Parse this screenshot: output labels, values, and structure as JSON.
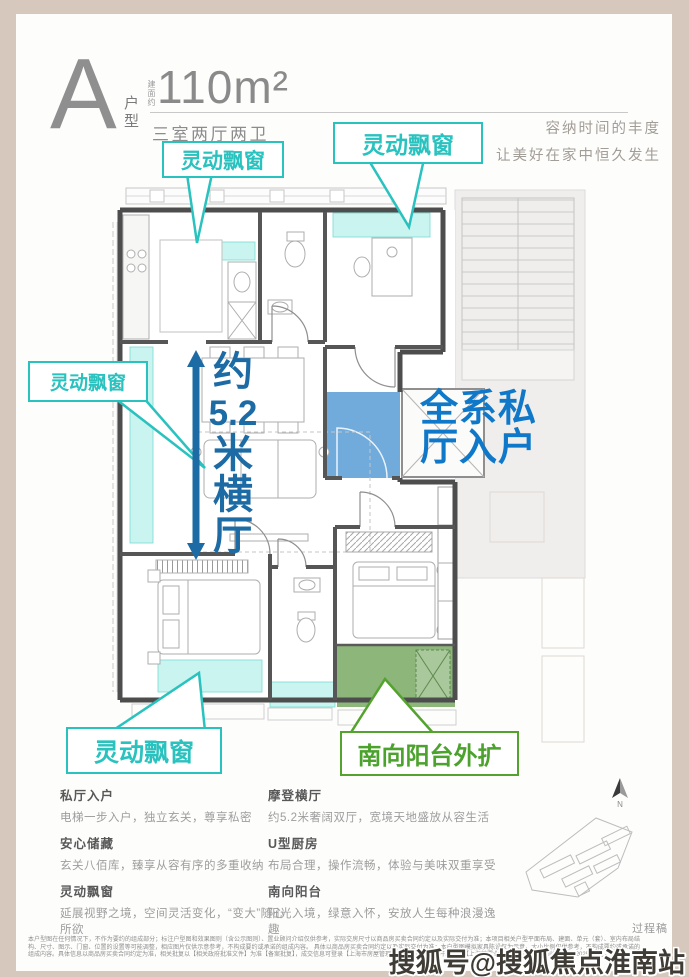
{
  "header": {
    "type_letter": "A",
    "type_label": "户型",
    "area_prefix": "建面约",
    "area": "110m²",
    "rooms": "三室两厅两卫",
    "slogan1": "容纳时间的丰度",
    "slogan2": "让美好在家中恒久发生"
  },
  "plan": {
    "bay_window_label": "灵动飘窗",
    "balcony_label": "南向阳台外扩",
    "hall_label": "全系私厅入户",
    "dimension_chars": [
      "约",
      "5.2",
      "米",
      "横",
      "厅"
    ],
    "north_label": "N",
    "colors": {
      "teal": "#29c2bf",
      "cyan_fill": "#c9f4ef",
      "green": "#55a32f",
      "green_fill": "#7fae6b",
      "blue_text": "#0f78c8",
      "blue_fill": "#64a4d8",
      "dim_blue": "#1d6ba5"
    }
  },
  "features": {
    "left": [
      {
        "title": "私厅入户",
        "desc": "电梯一步入户，独立玄关，尊享私密"
      },
      {
        "title": "安心储藏",
        "desc": "玄关八佰库，臻享从容有序的多重收纳"
      },
      {
        "title": "灵动飘窗",
        "desc": "延展视野之境，空间灵活变化，“变大”随心所欲"
      }
    ],
    "right": [
      {
        "title": "摩登横厅",
        "desc": "约5.2米奢阔双厅，宽境天地盛放从容生活"
      },
      {
        "title": "U型厨房",
        "desc": "布局合理，操作流畅，体验与美味双重享受"
      },
      {
        "title": "南向阳台",
        "desc": "阳光入境，绿意入怀，安放人生每种浪漫逸趣"
      }
    ]
  },
  "footer": {
    "draft": "过程稿",
    "disclaimer_lines": [
      "本户型图在任何情况下，不作为要约的组成部分；标注户型图和效果图则（含公示图则）、置业顾问介绍仅供参考，实际交房尺寸以商品房买卖合同约定以及实际交付为准；本项目相关户型平面布局、建面、单元（套）、室内布局结构、尺寸、图示、门窗、位置的设置等可能调整，相应图片仅供示意参考，不构成要约或承诺的组成内容。",
      "具体以商品房买卖合同约定以及实际交付为准；本户型图模拟家具陈设仅为示意，大小比例仅供参考，不构成要约或承诺的组成内容。具体信息以商品房买卖合同约定为准，相关批复以【相关政府批准文件】为准【备案批复】，成交信息可登录【上海市房屋管理部门网站】查询，开发商为【上海某置业有限公",
      "司】，资料制作时间为2025年5月。"
    ],
    "watermark": "搜狐号@搜狐焦点淮南站"
  }
}
